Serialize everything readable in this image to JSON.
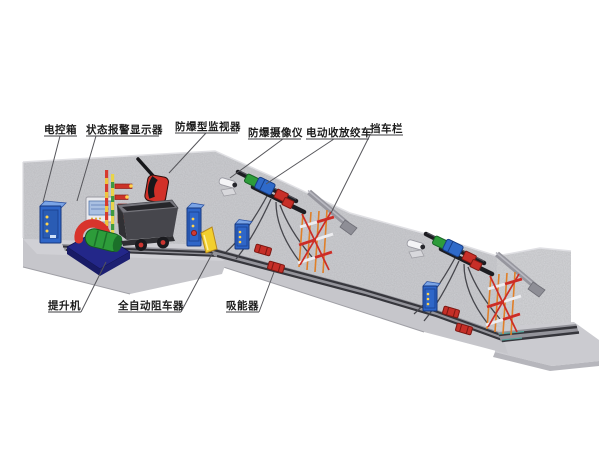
{
  "colors": {
    "background": "#ffffff",
    "wall": "#cdced2",
    "floor": "#c6c6cb",
    "rail": "#36363c",
    "cabinet_blue": "#2f66c8",
    "hoist_red": "#d8342c",
    "motor_green": "#2d9c3a",
    "base_navy": "#232789",
    "cart_gray": "#46464c",
    "barrier_orange": "#e07f28",
    "barrier_red": "#cc2d26",
    "absorber_red": "#c62f28",
    "beam_gray": "#96969e",
    "stopper_yellow": "#f2cf2e"
  },
  "callouts": {
    "top": [
      {
        "label": "电控箱"
      },
      {
        "label": "状态报警显示器"
      },
      {
        "label": "防爆型监视器"
      },
      {
        "label": "防爆摄像仪"
      },
      {
        "label": "电动收放绞车"
      },
      {
        "label": "挡车栏"
      }
    ],
    "bottom": [
      {
        "label": "提升机"
      },
      {
        "label": "全自动阻车器"
      },
      {
        "label": "吸能器"
      }
    ]
  }
}
